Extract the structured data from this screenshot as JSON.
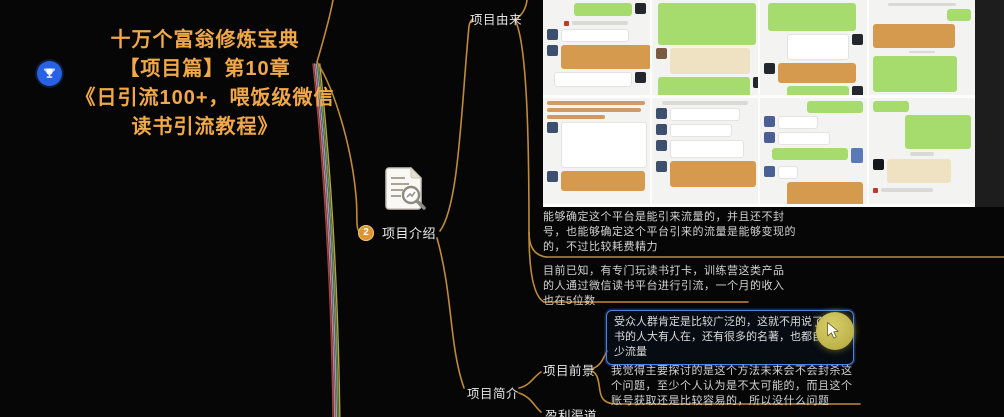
{
  "central_topic": {
    "lines": [
      "十万个富翁修炼宝典",
      "【项目篇】第10章",
      "《日引流100+，喂饭级微信",
      "读书引流教程》"
    ]
  },
  "nodes": {
    "intro": {
      "number": "2",
      "label": "项目介绍"
    },
    "origin": {
      "label": "项目由来"
    },
    "brief": {
      "label": "项目简介"
    },
    "prospect": {
      "label": "项目前景"
    },
    "profit": {
      "label": "盈利渠道"
    },
    "origin_note1": "能够确定这个平台是能引来流量的，并且还不封号，也能够确定这个平台引来的流量是能够变现的的，不过比较耗费精力",
    "origin_note2": "目前已知，有专门玩读书打卡，训练营这类产品的人通过微信读书平台进行引流，一个月的收入也在5位数",
    "audience_note": "受众人群肯定是比较广泛的，这就不用说了，读书的人大有人在，还有很多的名著，也都自带不少流量",
    "prospect_note": "我觉得主要探讨的是这个方法未来会不会封杀这个问题，至少个人认为是不太可能的，而且这个账号获取还是比较容易的，所以没什么问题"
  },
  "embedded_image": {
    "name": "wechat-chat-screenshot-collage",
    "panels": 8
  },
  "colors": {
    "background": "#060606",
    "branch_orange": "#c08a3a",
    "title_orange": "#f0a848",
    "highlight_border": "#4d82e8",
    "cursor_highlight": "#c3b852",
    "bubble_green": "#a6dc6e",
    "bubble_orange": "#d69a4e",
    "badge_orange": "#dc9434",
    "trophy_blue": "#2761e6"
  }
}
